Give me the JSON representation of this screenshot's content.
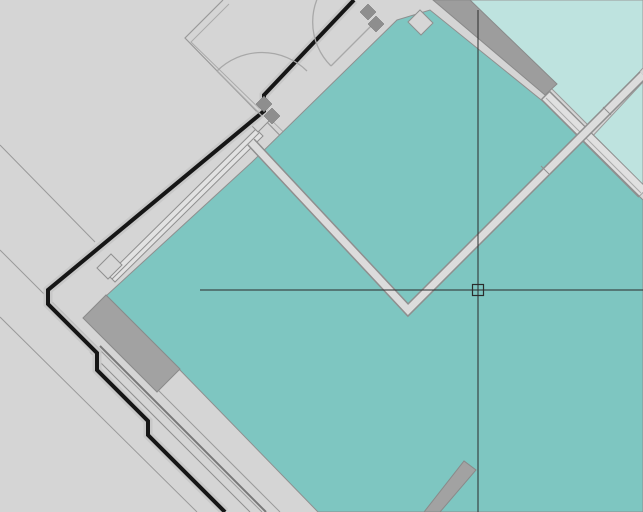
{
  "app": {
    "kind": "cad-floor-plan-viewport",
    "description": "CAD drawing viewport showing a rotated architectural floor plan with teal room fills and a crosshair cursor"
  },
  "canvas": {
    "width": 643,
    "height": 512,
    "background": "#d5d5d5"
  },
  "palette": {
    "background_gray": "#d5d5d5",
    "room_teal": "#7ec6c1",
    "room_teal_light": "#bee3df",
    "wall_poche_gray": "#9d9d9d",
    "wall_hollow_fill": "#dedede",
    "wall_line_gray": "#8f8f8f",
    "wall_black": "#161616",
    "crosshair_color": "#2b2b2b"
  },
  "cursor": {
    "x": 478,
    "y": 290,
    "pickbox_size": 11,
    "h_line": {
      "x1": 200,
      "y1": 290,
      "x2": 643,
      "y2": 290
    },
    "v_line": {
      "x1": 478,
      "y1": 10,
      "x2": 478,
      "y2": 512
    },
    "color": "#2b2b2b"
  },
  "plan": {
    "shapes": [
      {
        "name": "site-line-1",
        "type": "line",
        "x1": 0,
        "y1": 145,
        "x2": 95,
        "y2": 242,
        "stroke": "#9a9a9a",
        "sw": 1
      },
      {
        "name": "site-line-2",
        "type": "line",
        "x1": 0,
        "y1": 250,
        "x2": 262,
        "y2": 512,
        "stroke": "#9a9a9a",
        "sw": 1
      },
      {
        "name": "site-line-3",
        "type": "line",
        "x1": 0,
        "y1": 317,
        "x2": 197,
        "y2": 512,
        "stroke": "#9a9a9a",
        "sw": 1
      },
      {
        "name": "vestibule-wall-outer",
        "type": "path",
        "d": "M223,0 L185,38 L300,156",
        "stroke": "#999999",
        "sw": 1.2,
        "fill": "none"
      },
      {
        "name": "vestibule-wall-inner",
        "type": "path",
        "d": "M229,4 L191,42 L303,151",
        "stroke": "#ababab",
        "sw": 1,
        "fill": "none"
      },
      {
        "name": "room-main-fill",
        "type": "polygon",
        "points": "397,20 430,10 545,103 643,200 643,512 318,512 178,368 106,296 252,162",
        "fill": "#7ec6c1",
        "stroke": "#8f8f8f",
        "sw": 1
      },
      {
        "name": "room-upper-right-fill",
        "type": "polygon",
        "points": "470,0 643,0 643,68 590,127 553,90",
        "fill": "#bee3df",
        "stroke": "#9a9a9a",
        "sw": 1
      },
      {
        "name": "room-right-wedge-fill",
        "type": "polygon",
        "points": "589,140 643,82 643,186",
        "fill": "#bee3df",
        "stroke": "#9a9a9a",
        "sw": 1
      },
      {
        "name": "window-lower-line-1",
        "type": "line",
        "x1": 90,
        "y1": 352,
        "x2": 250,
        "y2": 512,
        "stroke": "#8f8f8f",
        "sw": 1
      },
      {
        "name": "window-lower-line-2",
        "type": "line",
        "x1": 100,
        "y1": 346,
        "x2": 266,
        "y2": 512,
        "stroke": "#787878",
        "sw": 2
      },
      {
        "name": "window-lower-line-3",
        "type": "line",
        "x1": 113,
        "y1": 345,
        "x2": 280,
        "y2": 512,
        "stroke": "#9a9a9a",
        "sw": 1
      },
      {
        "name": "window-upper-frame",
        "type": "polygon",
        "points": "108,275 256,129 263,136 115,282",
        "fill": "#e2e2e2",
        "stroke": "#8f8f8f",
        "sw": 1
      },
      {
        "name": "window-upper-mullion",
        "type": "line",
        "x1": 112,
        "y1": 279,
        "x2": 259,
        "y2": 133,
        "stroke": "#8f8f8f",
        "sw": 1
      },
      {
        "name": "window-upper-endblock-1",
        "type": "polygon",
        "points": "97,268 111,254 122,265 108,279",
        "fill": "#d6d6d6",
        "stroke": "#8f8f8f",
        "sw": 1
      },
      {
        "name": "window-upper-endblock-2",
        "type": "polygon",
        "points": "250,124 262,112 270,120 258,132",
        "fill": "#d6d6d6",
        "stroke": "#8f8f8f",
        "sw": 1
      },
      {
        "name": "entry-wall-face-band",
        "type": "path",
        "d": "M354,0 L264,95 L264,111 L48,290 L48,304 L97,353 L97,370 L133,406 L148,421 L148,435 L225,512",
        "stroke": "#c8c8c8",
        "sw": 9,
        "fill": "none"
      },
      {
        "name": "entry-wall-black",
        "type": "path",
        "d": "M354,0 L264,95 L264,111 L48,290 L48,304 L97,353 L97,370 L133,406 L148,421 L148,435 L225,512",
        "stroke": "#161616",
        "sw": 4,
        "fill": "none"
      },
      {
        "name": "wall-poche-left",
        "type": "polygon",
        "points": "83,318 106,295 180,369 157,392",
        "fill": "#a2a2a2",
        "stroke": "#8a8a8a",
        "sw": 1
      },
      {
        "name": "wall-poche-bottom",
        "type": "polygon",
        "points": "424,512 464,461 476,470 440,512",
        "fill": "#a2a2a2",
        "stroke": "#8a8a8a",
        "sw": 1
      },
      {
        "name": "wall-poche-top",
        "type": "polygon",
        "points": "433,0 470,0 557,84 545,95",
        "fill": "#9d9d9d",
        "stroke": "#8a8a8a",
        "sw": 1
      },
      {
        "name": "wall-right-outer",
        "type": "line",
        "x1": 545,
        "y1": 95,
        "x2": 643,
        "y2": 193,
        "stroke": "#8f8f8f",
        "sw": 13
      },
      {
        "name": "wall-right-fill",
        "type": "line",
        "x1": 546,
        "y1": 96,
        "x2": 643,
        "y2": 192,
        "stroke": "#e0e0e0",
        "sw": 10
      },
      {
        "name": "wall-right-centerline",
        "type": "line",
        "x1": 546,
        "y1": 98,
        "x2": 641,
        "y2": 193,
        "stroke": "#ababab",
        "sw": 1
      },
      {
        "name": "wall-partition-outer",
        "type": "path",
        "d": "M251,142 L408,310 L643,75",
        "stroke": "#8f8f8f",
        "sw": 10,
        "fill": "none"
      },
      {
        "name": "wall-partition-fill",
        "type": "path",
        "d": "M251,142 L408,310 L643,75",
        "stroke": "#dcdcdc",
        "sw": 7,
        "fill": "none"
      },
      {
        "name": "wall-joint-tick-1",
        "type": "line",
        "x1": 541,
        "y1": 166,
        "x2": 549,
        "y2": 174,
        "stroke": "#8f8f8f",
        "sw": 1
      },
      {
        "name": "wall-joint-tick-2",
        "type": "line",
        "x1": 603,
        "y1": 107,
        "x2": 611,
        "y2": 115,
        "stroke": "#8f8f8f",
        "sw": 1
      },
      {
        "name": "corner-column-diamond",
        "type": "polygon",
        "points": "408,22 420,10 433,23 421,35",
        "fill": "#d6d6d6",
        "stroke": "#8f8f8f",
        "sw": 1
      },
      {
        "name": "door-swing-arc-1",
        "type": "path",
        "d": "M217,71 A64,64 0 0 1 307,71",
        "stroke": "#a8a8a8",
        "sw": 1.3,
        "fill": "none"
      },
      {
        "name": "door-leaf-1",
        "type": "line",
        "x1": 262,
        "y1": 116,
        "x2": 217,
        "y2": 71,
        "stroke": "#a8a8a8",
        "sw": 1.3
      },
      {
        "name": "door-swing-arc-2",
        "type": "path",
        "d": "M331,-22 A62,62 0 0 0 331,66",
        "stroke": "#a8a8a8",
        "sw": 1.3,
        "fill": "none"
      },
      {
        "name": "door-leaf-2",
        "type": "line",
        "x1": 375,
        "y1": 22,
        "x2": 331,
        "y2": 66,
        "stroke": "#a8a8a8",
        "sw": 1.3
      },
      {
        "name": "door-hinge-block-1a",
        "type": "polygon",
        "points": "256,104 264,96 272,104 264,112",
        "fill": "#8e8e8e",
        "stroke": "#6e6e6e",
        "sw": 0.5
      },
      {
        "name": "door-hinge-block-1b",
        "type": "polygon",
        "points": "264,116 272,108 280,116 272,124",
        "fill": "#8e8e8e",
        "stroke": "#6e6e6e",
        "sw": 0.5
      },
      {
        "name": "door-hinge-block-2a",
        "type": "polygon",
        "points": "360,12 368,4 376,12 368,20",
        "fill": "#8e8e8e",
        "stroke": "#6e6e6e",
        "sw": 0.5
      },
      {
        "name": "door-hinge-block-2b",
        "type": "polygon",
        "points": "368,24 376,16 384,24 376,32",
        "fill": "#8e8e8e",
        "stroke": "#6e6e6e",
        "sw": 0.5
      }
    ]
  }
}
